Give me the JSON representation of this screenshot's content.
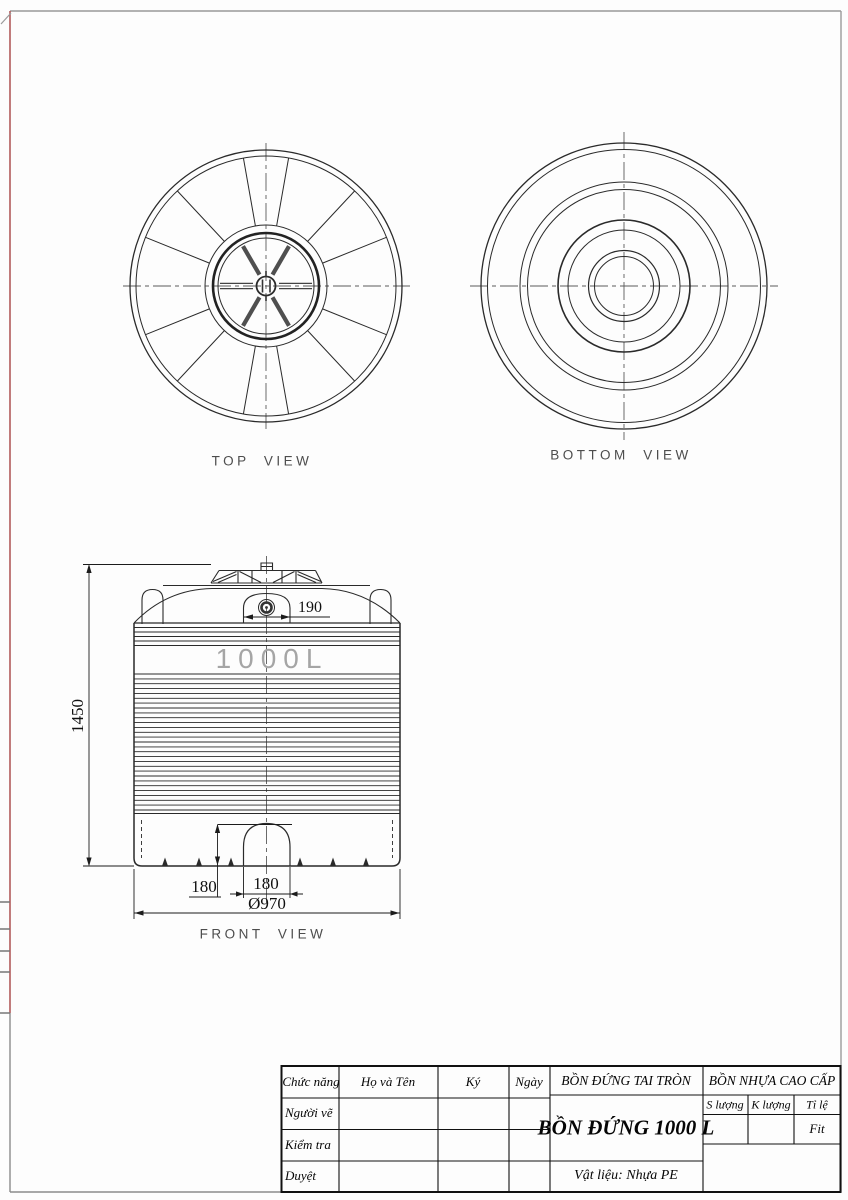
{
  "frame": {
    "accent_color": "#b25b5b",
    "border_color": "#9a9a9a"
  },
  "views": {
    "top": {
      "label": "TOP  VIEW"
    },
    "bottom": {
      "label": "BOTTOM  VIEW"
    },
    "front": {
      "label": "FRONT  VIEW",
      "capacity": "1000L"
    }
  },
  "dimensions": {
    "overall_height": "1450",
    "lid_opening": "190",
    "base_recess_height": "180",
    "base_recess_width": "180",
    "base_diameter": "Ø970"
  },
  "title_block": {
    "header": {
      "role": "Chức năng",
      "name": "Họ và Tên",
      "sign": "Ký",
      "date": "Ngày"
    },
    "rows": [
      {
        "label": "Người vẽ"
      },
      {
        "label": "Kiểm tra"
      },
      {
        "label": "Duyệt"
      }
    ],
    "product_type": "BỒN ĐỨNG TAI TRÒN",
    "product_title": "BỒN ĐỨNG 1000 L",
    "brand": "BỒN NHỰA CAO CẤP",
    "quantity_label": "S lượng",
    "weight_label": "K lượng",
    "scale_label": "Tỉ lệ",
    "scale_value": "Fit",
    "material": "Vật liệu: Nhựa PE"
  }
}
